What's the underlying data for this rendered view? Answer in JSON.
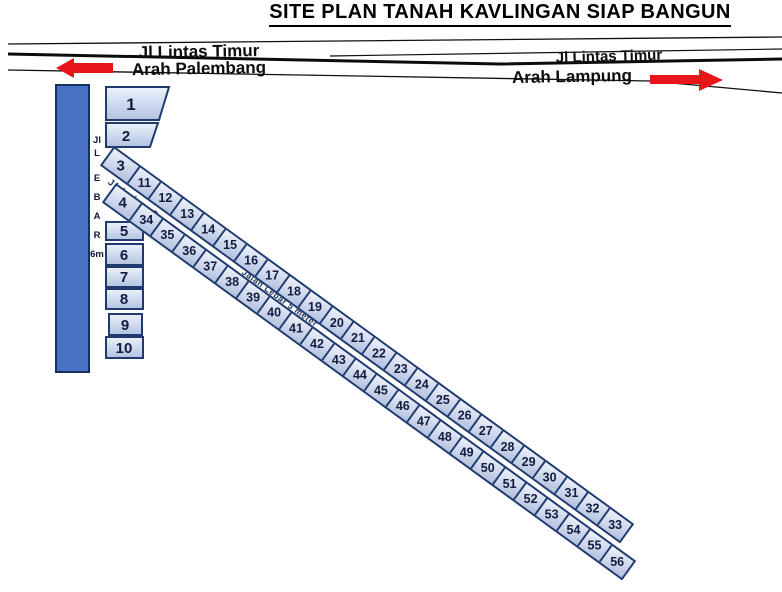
{
  "title": "SITE PLAN TANAH KAVLINGAN SIAP BANGUN",
  "highway": {
    "left": {
      "road_name": "Jl Lintas Timur",
      "direction": "Arah Palembang"
    },
    "right": {
      "road_name": "Jl Lintas Timur",
      "direction": "Arah Lampung"
    }
  },
  "side_road": {
    "chars": [
      "Jl",
      "L",
      "E",
      "B",
      "A",
      "R",
      "6m"
    ]
  },
  "inner_roads": {
    "label_1": "Jl Lebar 5 m",
    "label_2": "Jalan Lebar 5 meter"
  },
  "plots": {
    "left_column": [
      "1",
      "2",
      "5",
      "6",
      "7",
      "8",
      "9",
      "10"
    ],
    "upper_row": [
      "3",
      "11",
      "12",
      "13",
      "14",
      "15",
      "16",
      "17",
      "18",
      "19",
      "20",
      "21",
      "22",
      "23",
      "24",
      "25",
      "26",
      "27",
      "28",
      "29",
      "30",
      "31",
      "32",
      "33"
    ],
    "lower_row": [
      "4",
      "34",
      "35",
      "36",
      "37",
      "38",
      "39",
      "40",
      "41",
      "42",
      "43",
      "44",
      "45",
      "46",
      "47",
      "48",
      "49",
      "50",
      "51",
      "52",
      "53",
      "54",
      "55",
      "56"
    ]
  },
  "colors": {
    "arrow_red": "#e8151a",
    "strip_fill": "#4a72c4",
    "plot_border": "#1e3a6e",
    "number_color": "#131c3d",
    "line_black": "#0d0d0d"
  }
}
